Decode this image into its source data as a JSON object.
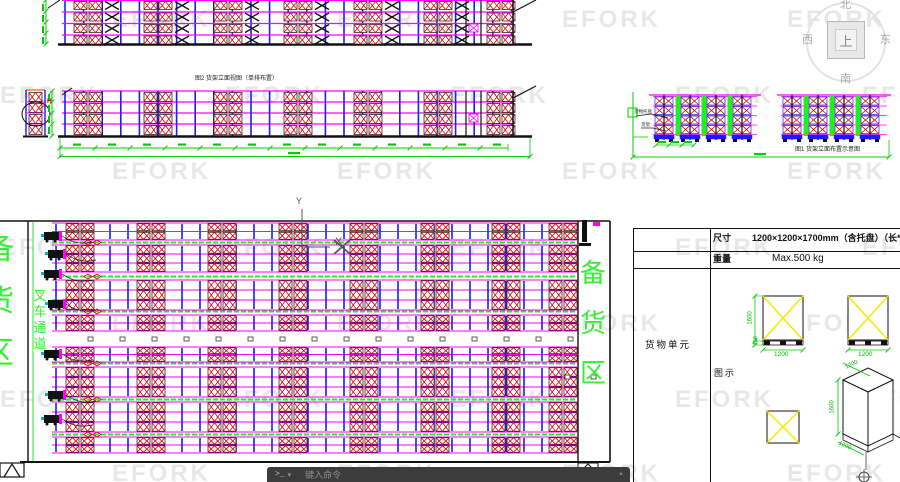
{
  "watermark": {
    "text": "EFORK"
  },
  "viewcube": {
    "north": "北",
    "south": "南",
    "east": "东",
    "west": "西",
    "top_face": "上"
  },
  "drawings": {
    "elevation_caption": "图2 货架立面视图（单排布置）",
    "side_caption": "图1 货架立面布置示意图",
    "leader_pallet": "货物托盘",
    "leader_rack": "货架",
    "detail_label": "H",
    "axis_x": "X",
    "axis_y": "Y"
  },
  "plan": {
    "left_area": "备货区",
    "aisle": "叉车通道",
    "right_area": "备货区"
  },
  "spec_table": {
    "dim_label": "尺寸",
    "dim_value": "1200×1200×1700mm（含托盘）（长*宽*高）",
    "weight_label": "重量",
    "weight_value": "Max.500 kg",
    "unit_label": "货物单元",
    "figure_label": "图示",
    "dims": {
      "front_h": "1600",
      "pallet_h": "150",
      "front_w": "1200",
      "front_w2": "1200",
      "iso_d": "1200",
      "iso_h": "1600",
      "iso_w": "1200"
    }
  },
  "command_bar": {
    "prompt": ">_",
    "placeholder": "键入命令"
  },
  "icons": {
    "dropdown_caret": "▾",
    "scroll_up": "▲"
  },
  "colors": {
    "beam": "#ff00ff",
    "post": "#1a1aff",
    "pallet": "#e00000",
    "dim": "#00cc00",
    "flue": "#22ee22",
    "area_text": "#35f035",
    "highlight": "#f5e900",
    "bar_bg": "#3c3c3c"
  }
}
